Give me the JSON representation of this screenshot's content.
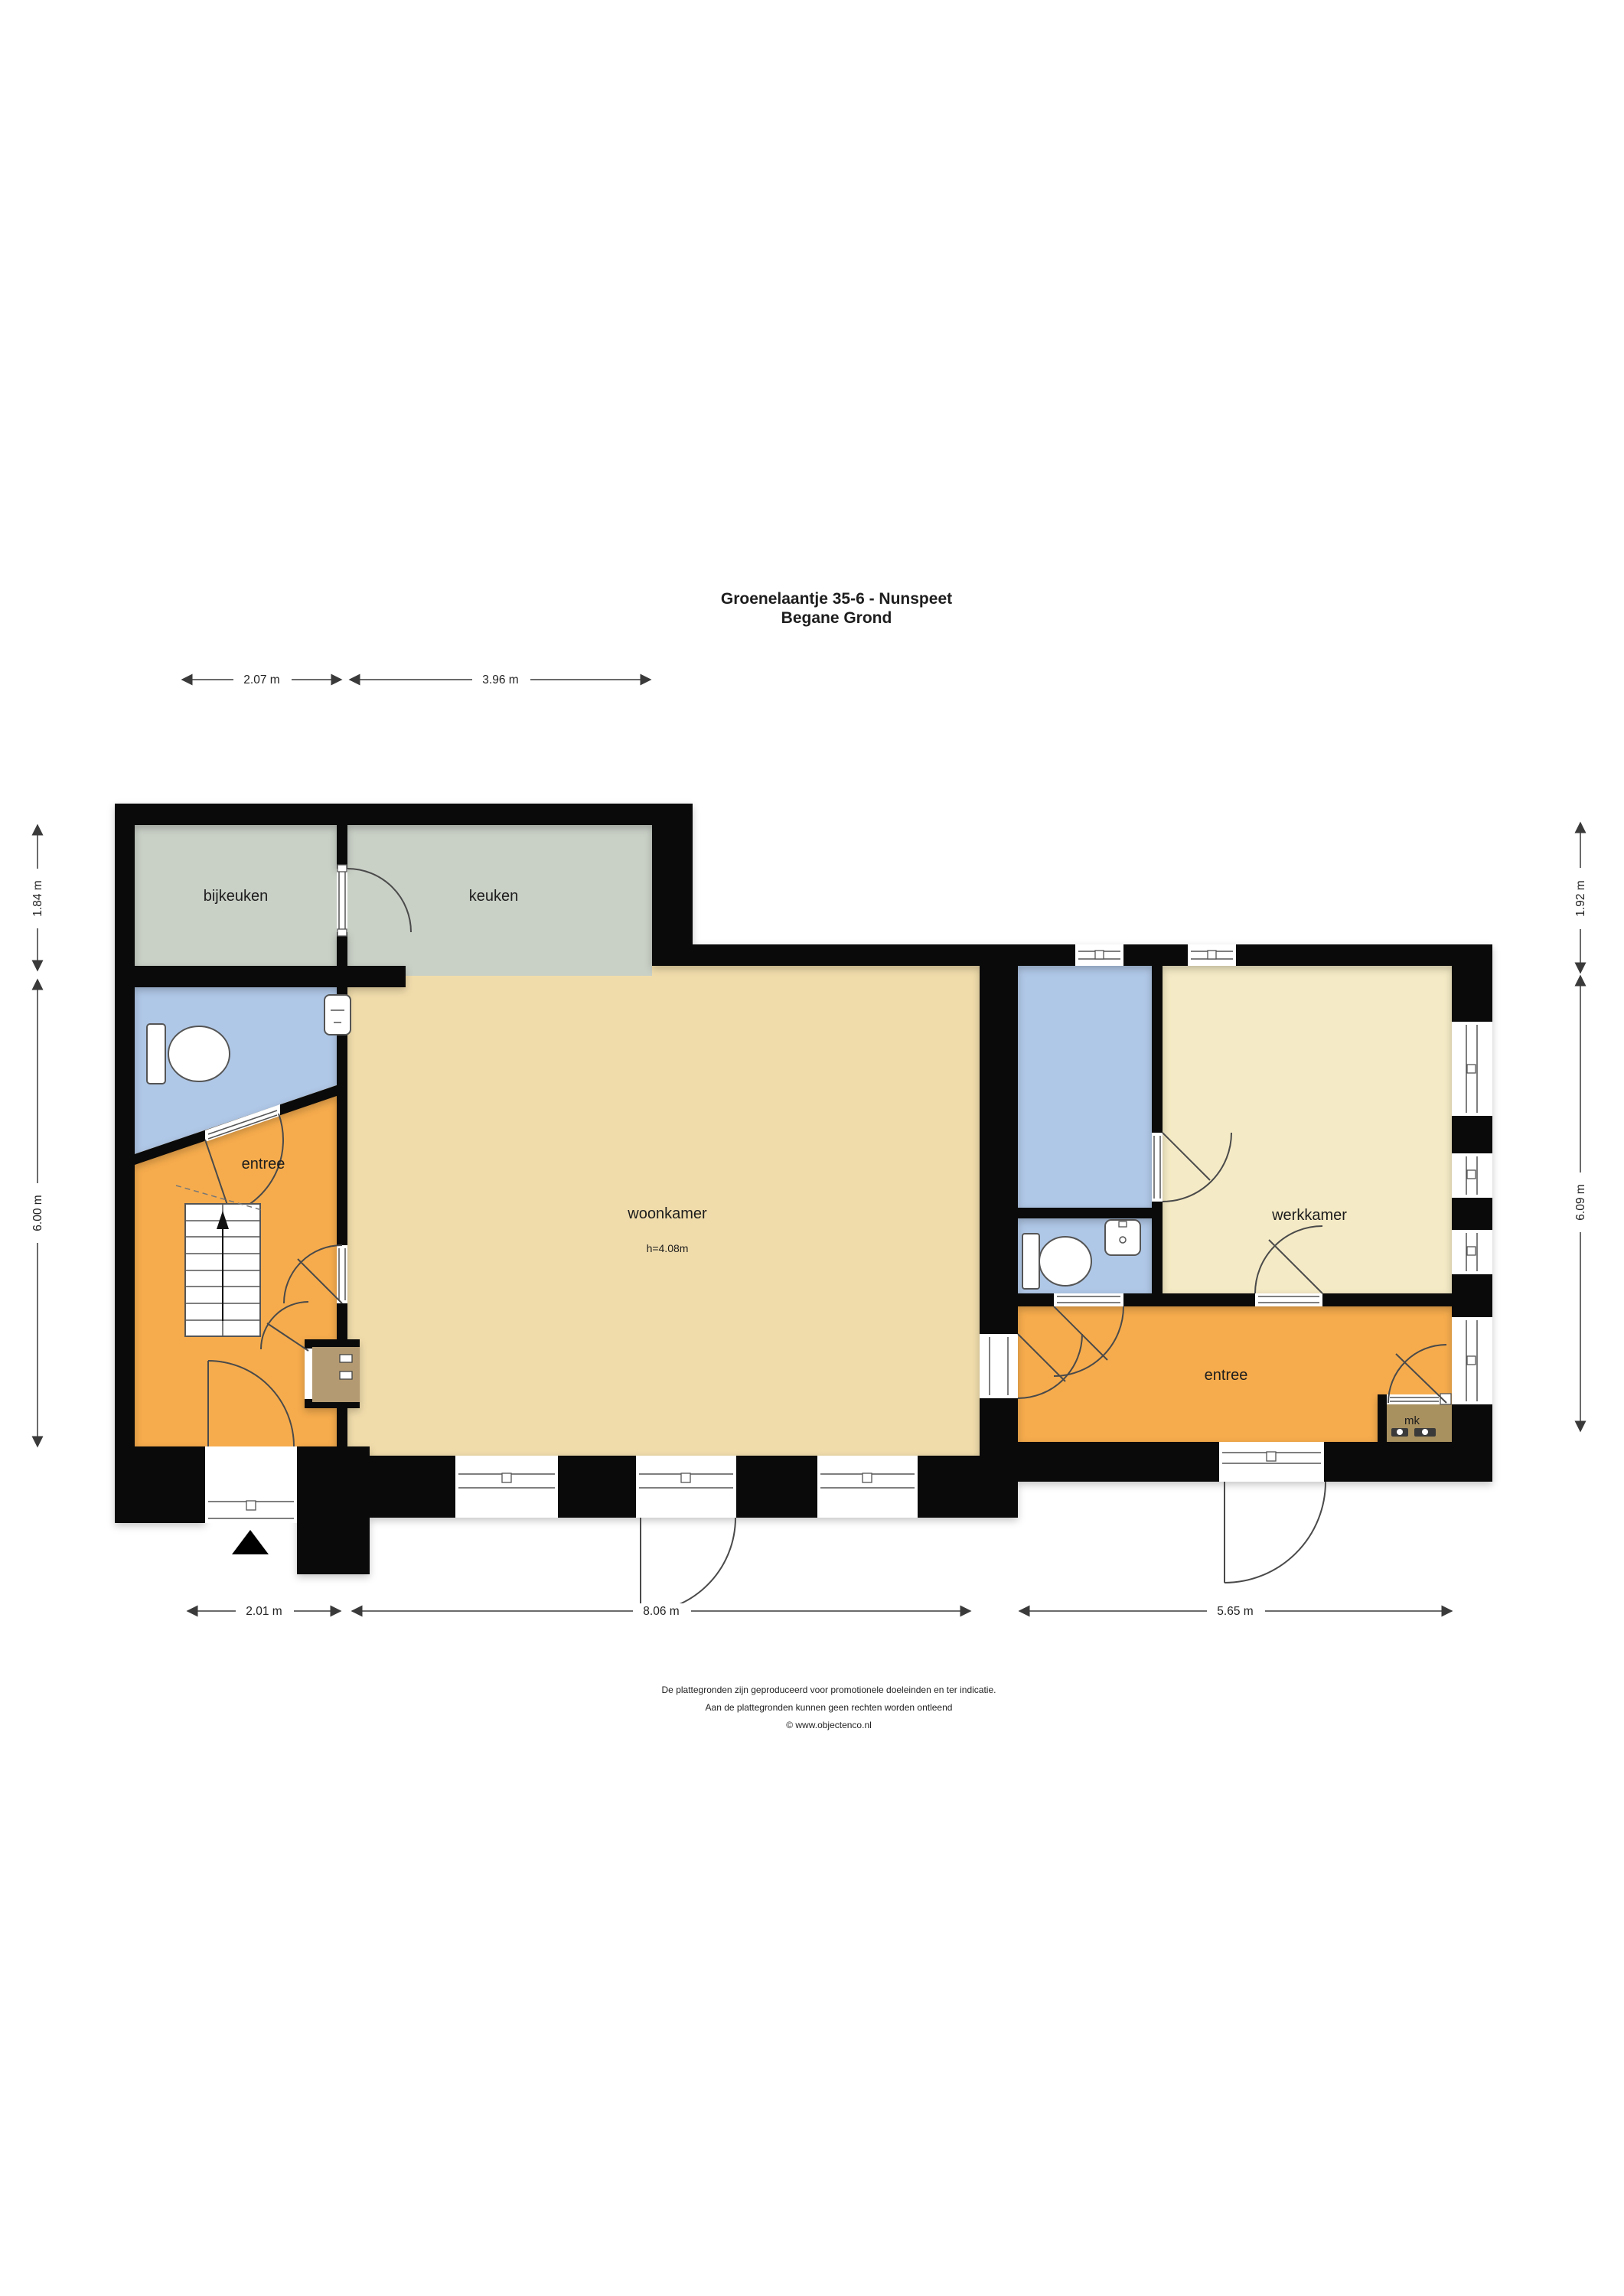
{
  "title": {
    "line1": "Groenelaantje 35-6 - Nunspeet",
    "line2": "Begane Grond"
  },
  "rooms": {
    "bijkeuken": "bijkeuken",
    "keuken": "keuken",
    "entree_left": "entree",
    "woonkamer": "woonkamer",
    "woonkamer_height": "h=4.08m",
    "werkkamer": "werkkamer",
    "entree_right": "entree",
    "mk": "mk"
  },
  "dimensions": {
    "top": [
      "2.07 m",
      "3.96 m"
    ],
    "left": [
      "1.84 m",
      "6.00 m"
    ],
    "right": [
      "1.92 m",
      "6.09 m"
    ],
    "bottom": [
      "2.01 m",
      "8.06 m",
      "5.65 m"
    ]
  },
  "footer": {
    "line1": "De plattegronden zijn geproduceerd voor promotionele doeleinden en ter indicatie.",
    "line2": "Aan de plattegronden kunnen geen rechten worden ontleend",
    "line3": "© www.objectenco.nl"
  },
  "colors": {
    "wall": "#0a0a0a",
    "grey_room": "#c9d0c6",
    "tan_room": "#f0dcab",
    "orange_room": "#f6ac4d",
    "blue_room": "#b0c8e7",
    "cream_room": "#f4eac5",
    "mk_room": "#a8905f",
    "closet_room": "#b49a72",
    "dim_line": "#3a3a3a"
  }
}
